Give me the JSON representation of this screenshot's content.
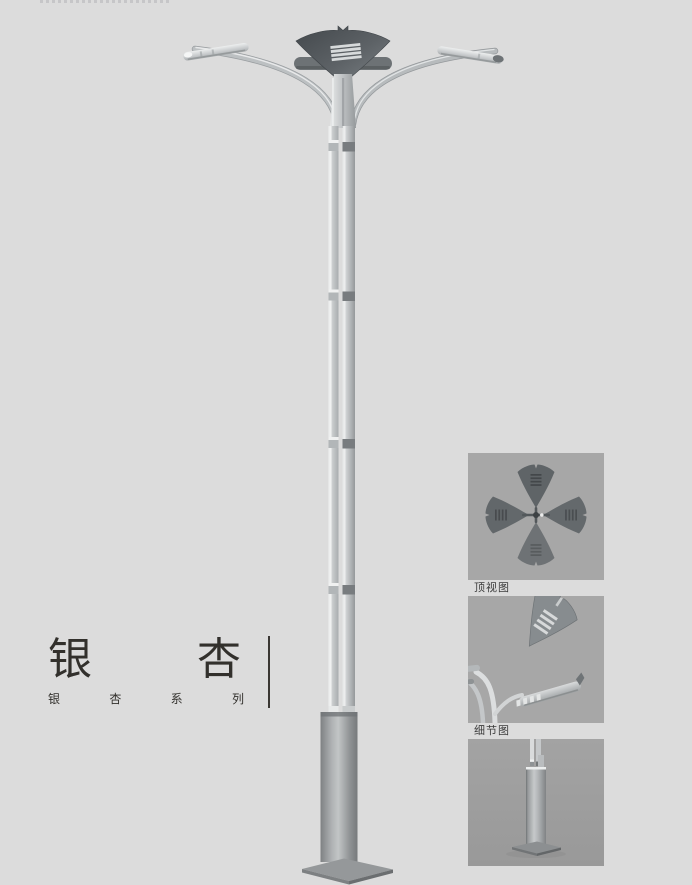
{
  "title_block": {
    "main_chars": [
      "银",
      "杏"
    ],
    "main_text": "银杏",
    "series_chars": [
      "银",
      "杏",
      "系",
      "列"
    ],
    "series_text": "银杏系列"
  },
  "figures": {
    "top_view": {
      "caption": "顶视图"
    },
    "detail_view": {
      "caption": "细节图"
    },
    "base_view": {
      "caption": ""
    }
  },
  "colors": {
    "page_background": "#dcdcdc",
    "figure_background": "#a7a7a7",
    "lamp_dark_metal": "#565b5f",
    "lamp_light_metal": "#c6c9cb",
    "title_text": "#32302c",
    "caption_text": "#3c3c3c"
  }
}
